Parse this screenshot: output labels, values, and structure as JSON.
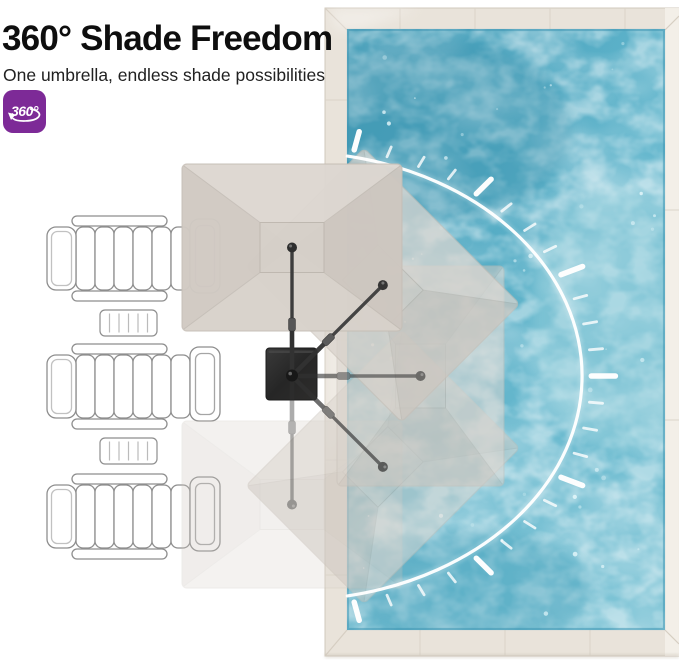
{
  "header": {
    "title": "360° Shade Freedom",
    "subtitle": "One umbrella, endless shade possibilities"
  },
  "badge": {
    "label": "360°",
    "bg_color": "#7d2a97",
    "text_color": "#ffffff"
  },
  "illustration": {
    "type": "top-view-pool-scene",
    "umbrella_positions_deg": [
      0,
      45,
      90,
      135,
      180
    ],
    "lounge_chairs": 3,
    "side_tables": 2,
    "colors": {
      "pool_water": "#55afc8",
      "deck_stone": "#e9e3da",
      "canopy_gray": "#d5cfc8",
      "umbrella_base": "#2b2a29",
      "rotation_arc": "#ffffff",
      "chair_outline": "#8e8e8e"
    }
  }
}
